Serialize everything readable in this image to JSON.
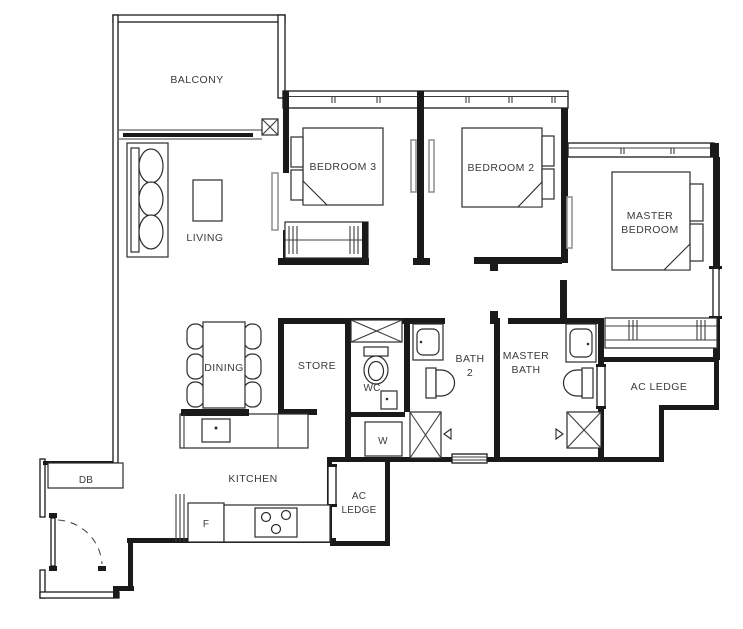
{
  "plan": {
    "type": "apartment-floor-plan",
    "rooms": {
      "balcony": {
        "label": "BALCONY"
      },
      "living": {
        "label": "LIVING"
      },
      "bedroom3": {
        "label": "BEDROOM 3"
      },
      "bedroom2": {
        "label": "BEDROOM 2"
      },
      "master_bedroom": {
        "line1": "MASTER",
        "line2": "BEDROOM"
      },
      "dining": {
        "label": "DINING"
      },
      "store": {
        "label": "STORE"
      },
      "wc": {
        "label": "WC"
      },
      "bath2": {
        "line1": "BATH",
        "line2": "2"
      },
      "master_bath": {
        "line1": "MASTER",
        "line2": "BATH"
      },
      "ac_ledge_right": {
        "label": "AC LEDGE"
      },
      "ac_ledge_kitchen": {
        "line1": "AC",
        "line2": "LEDGE"
      },
      "kitchen": {
        "label": "KITCHEN"
      },
      "db": {
        "label": "DB"
      },
      "fridge": {
        "label": "F"
      },
      "washer": {
        "label": "W"
      }
    },
    "colors": {
      "wall": "#1a1a1a",
      "sliding_door": "#949494",
      "background": "#ffffff",
      "text": "#3a3a3a"
    }
  }
}
